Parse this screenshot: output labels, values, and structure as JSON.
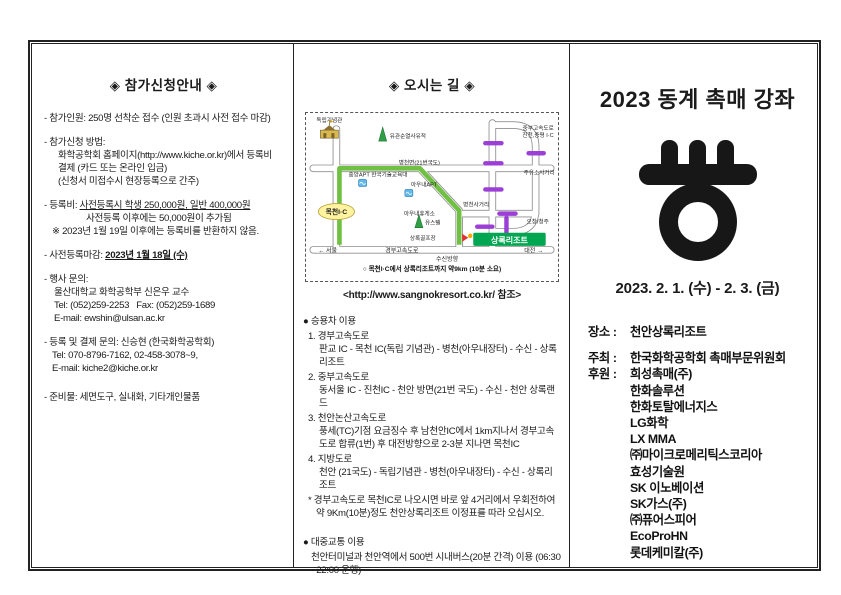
{
  "left": {
    "title": "◈ 참가신청안내 ◈",
    "capacity": "- 참가인원: 250명 선착순 접수 (인원 초과시 사전 접수 마감)",
    "apply_head": "- 참가신청 방법:",
    "apply_l1": "화학공학회 홈페이지(http://www.kiche.or.kr)에서 등록비",
    "apply_l2": "결제 (카드 또는 온라인 입금)",
    "apply_l3": "(신청서 미접수시 현장등록으로 간주)",
    "fee_label": "- 등록비: ",
    "fee_underlined": "사전등록시 학생 250,000원, 일반 400,000원",
    "fee_l2": "사전등록 이후에는 50,000원이 추가됨",
    "fee_note": "※ 2023년 1월 19일 이후에는 등록비를 반환하지 않음.",
    "deadline_label": "- 사전등록마감: ",
    "deadline_value": "2023년 1월 18일 (수)",
    "event_contact_head": "- 행사 문의:",
    "event_contact_l1": "울산대학교 화학공학부 신은우 교수",
    "event_contact_l2": "Tel: (052)259-2253   Fax: (052)259-1689",
    "event_contact_l3": "E-mail: ewshin@ulsan.ac.kr",
    "reg_contact_head": "- 등록 및 결제 문의: 신승현 (한국화학공학회)",
    "reg_contact_l1": "Tel: 070-8796-7162, 02-458-3078~9,",
    "reg_contact_l2": "E-mail: kiche2@kiche.or.kr",
    "supplies": "- 준비물: 세면도구, 실내화, 기타개인물품"
  },
  "middle": {
    "title": "◈ 오시는 길 ◈",
    "map": {
      "labels": {
        "independence_hall": "독립기념관",
        "jungbu_line1": "중부고속도로",
        "jungbu_line2": "진천,증평 I·C",
        "yugwansun": "유관순열사유적",
        "byeongcheon_road": "병천면(21번국도)",
        "jungang_apt": "중앙APT 한국기술교육대",
        "aunae_apt": "아우내APT",
        "mokcheon_ic": "목천I·C",
        "gas_junction": "주유소사거리",
        "byeongcheon_junction": "병천사거리",
        "aunae_rest": "아우내휴게소",
        "youth_hostel": "유스텔",
        "sangnok_golf": "상록골프장",
        "sangnok_resort": "상록리조트",
        "ochang": "오창/청주",
        "seoul": "← 서울",
        "gyeongbu_expwy": "경부고속도로",
        "susin": "수신방향",
        "daejeon": "대전 →"
      },
      "note": "○ 목천I·C에서 상록리조트까지 약9km (10분 소요)",
      "colors": {
        "route": "#6fc043",
        "marker": "#9b3fd6",
        "resort": "#00a651",
        "ic_oval": "#fff3a0"
      }
    },
    "caption": "<http://www.sangnokresort.co.kr/ 참조>",
    "car": {
      "header": "● 승용차 이용",
      "routes": [
        {
          "name": "1. 경부고속도로",
          "desc": "판교 IC - 목천 IC(독립 기념관) - 병천(아우내장터) - 수신 - 상록리조트"
        },
        {
          "name": "2. 중부고속도로",
          "desc": "동서울 IC - 진천IC - 천안 방면(21번 국도) - 수신 - 천안 상록랜드"
        },
        {
          "name": "3. 천안논산고속도로",
          "desc": "풍세(TC)기점 요금징수 후 남천안IC에서 1km지나서 경부고속도로 합류(1번) 후 대전방향으로 2-3분 지나면 목천IC"
        },
        {
          "name": "4. 지방도로",
          "desc": "천안 (21국도) - 독립기념관 - 병천(아우내장터) - 수신 - 상록리조트"
        }
      ],
      "tip": "* 경부고속도로 목천IC로 나오시면 바로 앞 4거리에서 우회전하여 약 9Km(10분)정도 천안상록리조트 이정표를 따라 오십시오."
    },
    "transit": {
      "header": "● 대중교통 이용",
      "desc": "천안터미널과 천안역에서 500번 시내버스(20분 간격) 이용 (06:30 - 22:00 운행)"
    }
  },
  "right": {
    "title": "2023 동계 촉매 강좌",
    "date": "2023. 2. 1. (수) - 2. 3. (금)",
    "place_label": "장소 :",
    "place": "천안상록리조트",
    "host_label": "주최 :",
    "host": "한국화학공학회 촉매부문위원회",
    "sponsor_label": "후원 :",
    "sponsors": [
      "희성촉매(주)",
      "한화솔루션",
      "한화토탈에너지스",
      "LG화학",
      "LX MMA",
      "㈜마이크로메리틱스코리아",
      "효성기술원",
      "SK 이노베이션",
      "SK가스(주)",
      "㈜퓨어스피어",
      "EcoProHN",
      "롯데케미칼(주)"
    ]
  }
}
